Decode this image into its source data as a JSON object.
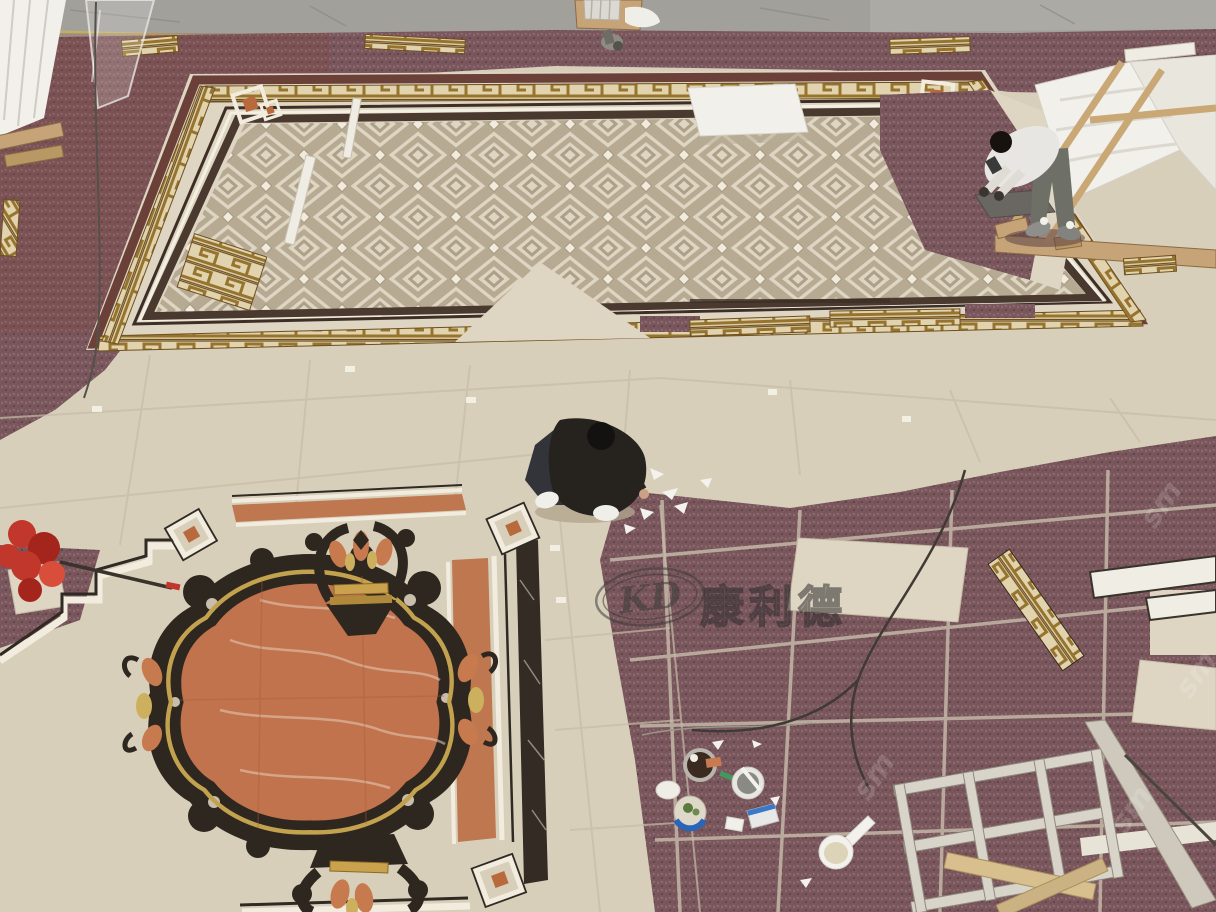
{
  "watermark": {
    "logo_letters": "KD",
    "logo_cn": "康利德",
    "side_fragment": "sm"
  },
  "palette": {
    "cream_tile": "#d8cfbb",
    "cream_tile_light": "#ded5c2",
    "taupe_diamond": "#b7aa93",
    "gold_border": "#96742e",
    "gold_border_bg": "#e0d3ae",
    "purple_floor": "#79575c",
    "maroon_band": "#6a4038",
    "rust_marble": "#c0734c",
    "orange_band": "#bf7750",
    "black_marble": "#2e2720",
    "concrete": "#a2a09b",
    "white_marble": "#f2f0ea",
    "wood": "#c6a478",
    "duster_red": "#c2372b",
    "grout_line": "#c6bca6",
    "worker_shirt_dark": "#26231f",
    "worker_shirt_light": "#e8e6e2",
    "worker_pants_grey": "#6e6f66"
  }
}
